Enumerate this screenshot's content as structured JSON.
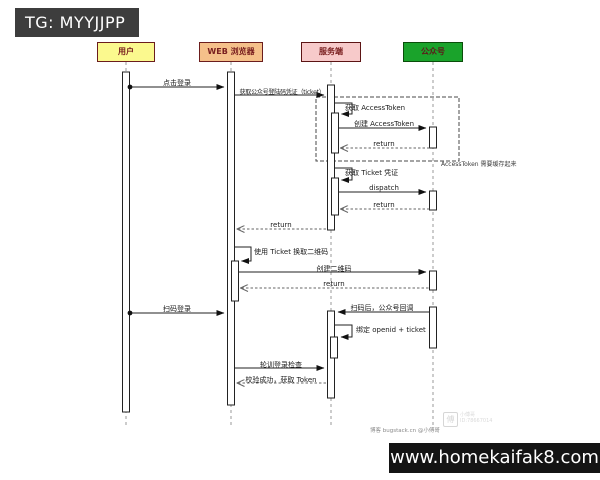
{
  "banners": {
    "top": "TG: MYYJJPP",
    "bottom": "www.homekaifak8.com"
  },
  "actors": [
    {
      "id": "user",
      "label": "用户",
      "color": "#fbf98e"
    },
    {
      "id": "browser",
      "label": "WEB 浏览器",
      "color": "#f5c08a"
    },
    {
      "id": "server",
      "label": "服务端",
      "color": "#f7caca"
    },
    {
      "id": "mp",
      "label": "公众号",
      "color": "#1aa32b"
    }
  ],
  "messages": [
    {
      "label": "点击登录",
      "from": "用户",
      "to": "WEB 浏览器",
      "type": "solid"
    },
    {
      "label": "获取公众号登陆码凭证（ticket）",
      "from": "WEB 浏览器",
      "to": "服务端",
      "type": "solid"
    },
    {
      "label": "获取 AccessToken",
      "from": "服务端",
      "to": "服务端",
      "type": "self"
    },
    {
      "label": "创建 AccessToken",
      "from": "服务端",
      "to": "公众号",
      "type": "solid"
    },
    {
      "label": "return",
      "from": "公众号",
      "to": "服务端",
      "type": "return"
    },
    {
      "label": "获取 Ticket 凭证",
      "from": "服务端",
      "to": "服务端",
      "type": "self"
    },
    {
      "label": "dispatch",
      "from": "服务端",
      "to": "公众号",
      "type": "solid"
    },
    {
      "label": "return",
      "from": "公众号",
      "to": "服务端",
      "type": "return"
    },
    {
      "label": "return",
      "from": "服务端",
      "to": "WEB 浏览器",
      "type": "return"
    },
    {
      "label": "使用 Ticket 换取二维码",
      "from": "WEB 浏览器",
      "to": "WEB 浏览器",
      "type": "self"
    },
    {
      "label": "创建二维码",
      "from": "WEB 浏览器",
      "to": "公众号",
      "type": "solid"
    },
    {
      "label": "return",
      "from": "公众号",
      "to": "WEB 浏览器",
      "type": "return"
    },
    {
      "label": "扫码登录",
      "from": "用户",
      "to": "WEB 浏览器",
      "type": "solid"
    },
    {
      "label": "扫码后，公众号回调",
      "from": "公众号",
      "to": "服务端",
      "type": "solid"
    },
    {
      "label": "绑定 openid + ticket",
      "from": "服务端",
      "to": "服务端",
      "type": "self"
    },
    {
      "label": "轮训登录检查",
      "from": "WEB 浏览器",
      "to": "服务端",
      "type": "solid"
    },
    {
      "label": "校验成功，获取 Token",
      "from": "服务端",
      "to": "WEB 浏览器",
      "type": "return"
    }
  ],
  "note": {
    "text": "AccessToken 需要缓存起来"
  },
  "credit": {
    "text": "博客 bugstack.cn @小傅哥"
  },
  "logo": {
    "glyph": "傅",
    "line1": "小傅哥",
    "line2": "ID:78667014"
  }
}
